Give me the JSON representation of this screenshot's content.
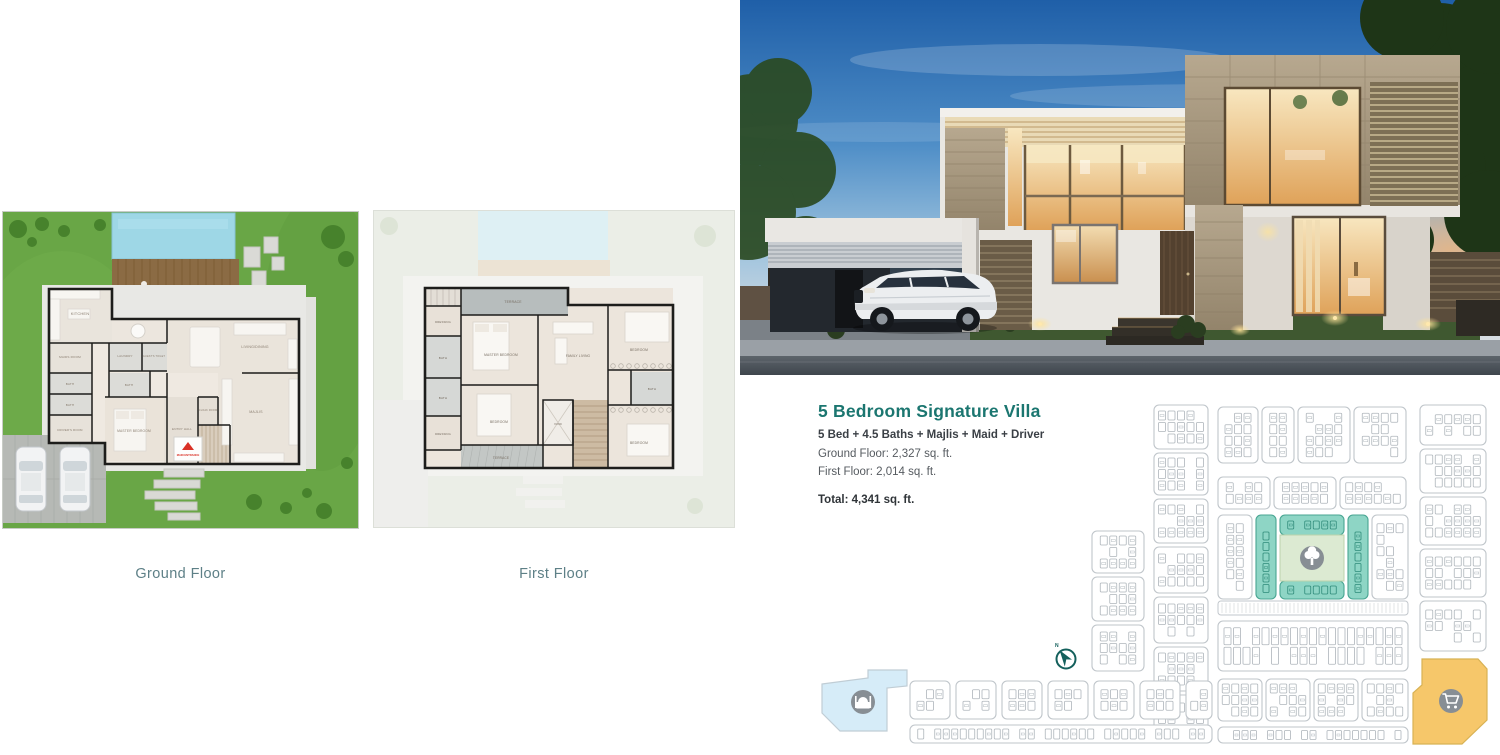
{
  "details": {
    "title": "5 Bedroom Signature Villa",
    "specs": "5 Bed + 4.5 Baths + Majlis + Maid + Driver",
    "ground_area": "Ground Floor: 2,327 sq. ft.",
    "first_area": "First Floor: 2,014 sq. ft.",
    "total_area": "Total: 4,341 sq. ft."
  },
  "plans": {
    "ground": {
      "label": "Ground Floor",
      "rooms": {
        "kitchen": "KITCHEN",
        "maids_room": "MAIDS ROOM",
        "bath_a": "BATH",
        "bath_b": "BATH",
        "drivers_room": "DRIVER'S ROOM",
        "laundry": "LAUNDRY",
        "guest_toilet": "GUEST'S TOILET",
        "bath_c": "BATH",
        "master_bedroom": "MASTER BEDROOM",
        "entry_hall": "ENTRY HALL",
        "cloak_room": "CLOAK ROOM",
        "living_dining": "LIVING/DINING",
        "majlis": "MAJLIS",
        "main_entrance": "MAIN ENTRANCE"
      }
    },
    "first": {
      "label": "First Floor",
      "rooms": {
        "terrace_top": "TERRACE",
        "dressing_a": "DRESSING",
        "bath_a": "BATH",
        "bath_b": "BATH",
        "dressing_b": "DRESSING",
        "master_bedroom": "MASTER BEDROOM",
        "bedroom_a": "BEDROOM",
        "terrace_bottom": "TERRACE",
        "family_living": "FAMILY LIVING",
        "void": "VOID",
        "bedroom_b": "BEDROOM",
        "bath_c": "BATH",
        "bedroom_c": "BEDROOM"
      }
    }
  },
  "master_plan": {
    "north_label": "N",
    "icons": {
      "park": "tree-icon",
      "mosque": "mosque-icon",
      "retail": "shopping-cart-icon",
      "north": "north-arrow-icon"
    }
  },
  "colors": {
    "accent_teal": "#1b7670",
    "plan_label_teal": "#5e8087",
    "highlight_teal": "#8ed5c5",
    "park_green": "#dcead2",
    "retail_orange": "#f6c76a",
    "mosque_blue": "#d6ecf8",
    "grass_green": "#69a646",
    "pool_blue": "#9ed7e6",
    "deck_brown": "#8b6b44",
    "text_dark": "#3a3f45",
    "text_body": "#565b60"
  }
}
